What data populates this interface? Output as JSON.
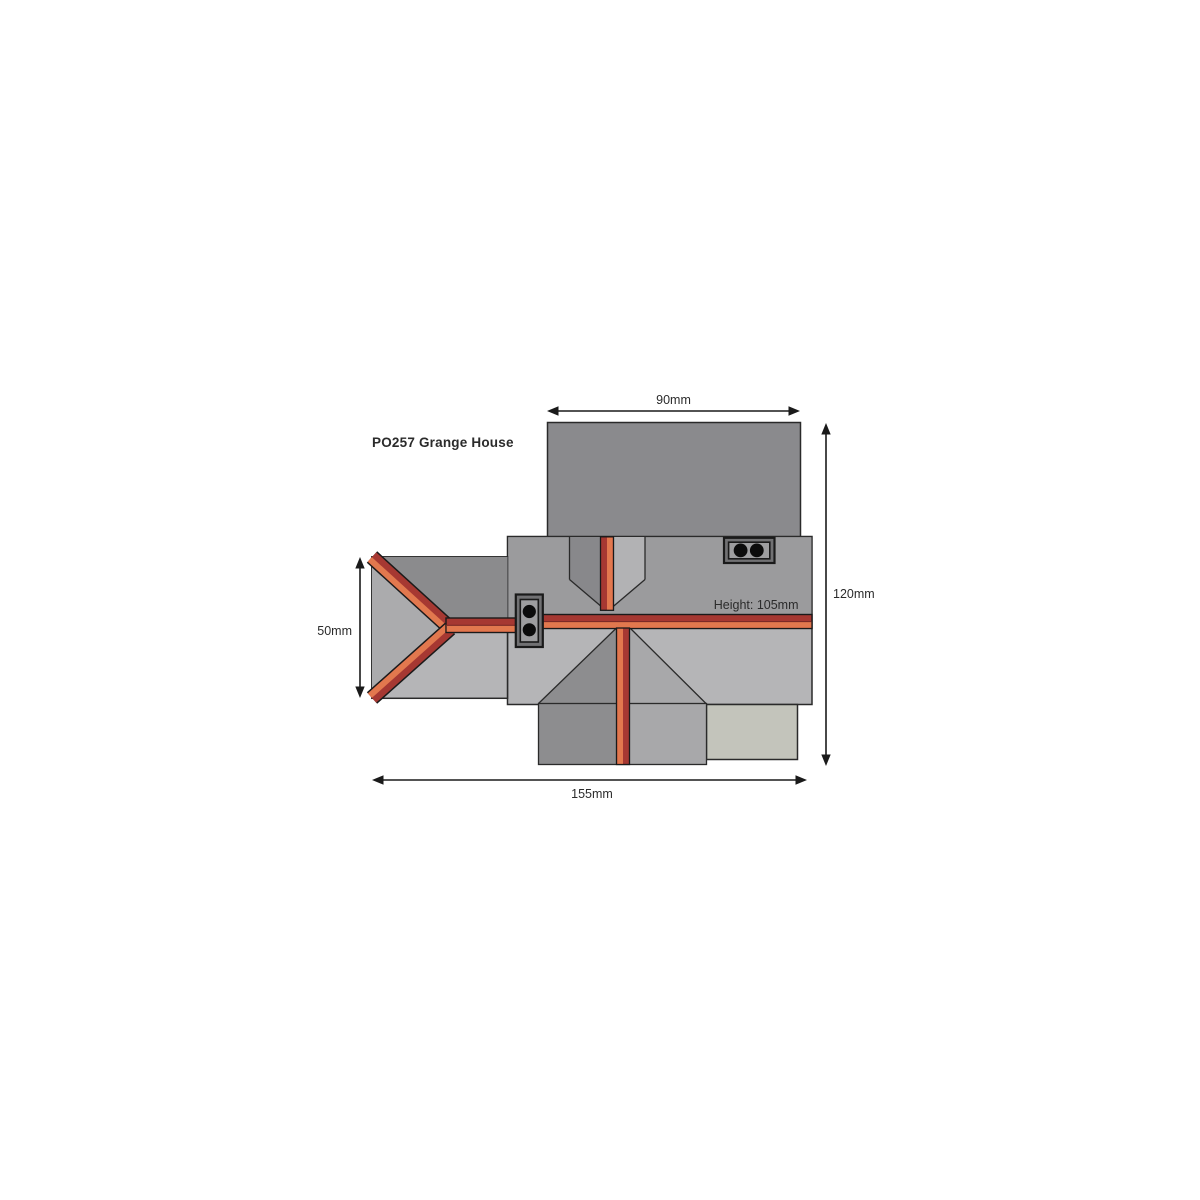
{
  "title": "PO257 Grange House",
  "plan": {
    "view": "roof plan, top view",
    "dimension_labels": {
      "top": "90mm",
      "right": "120mm",
      "left": "50mm",
      "bottom": "155mm",
      "height_note": "Height: 105mm"
    },
    "chimneys": [
      {
        "name": "left-chimney",
        "pots": 2,
        "orientation": "vertical"
      },
      {
        "name": "top-right-chimney",
        "pots": 2,
        "orientation": "horizontal"
      }
    ],
    "colors": {
      "background": "#ffffff",
      "roof_dark": "#8a8a8d",
      "roof_mid": "#9b9b9d",
      "roof_light": "#b5b5b7",
      "roof_light_mid": "#a8a8aa",
      "wing_west_slope": "#ababad",
      "valley_left_slope": "#88888b",
      "valley_right_slope": "#b2b2b4",
      "annex_roof": "#c3c4bb",
      "ridge_crimson": "#a63832",
      "ridge_orange": "#e2784e",
      "ridge_divider": "#7c2a27",
      "chimney_frame": "#717173",
      "chimney_panel": "#9e9ea0",
      "chimney_pot": "#0c0c0c",
      "outline": "#2a2a2a",
      "dimension_line": "#1a1a1a"
    }
  }
}
